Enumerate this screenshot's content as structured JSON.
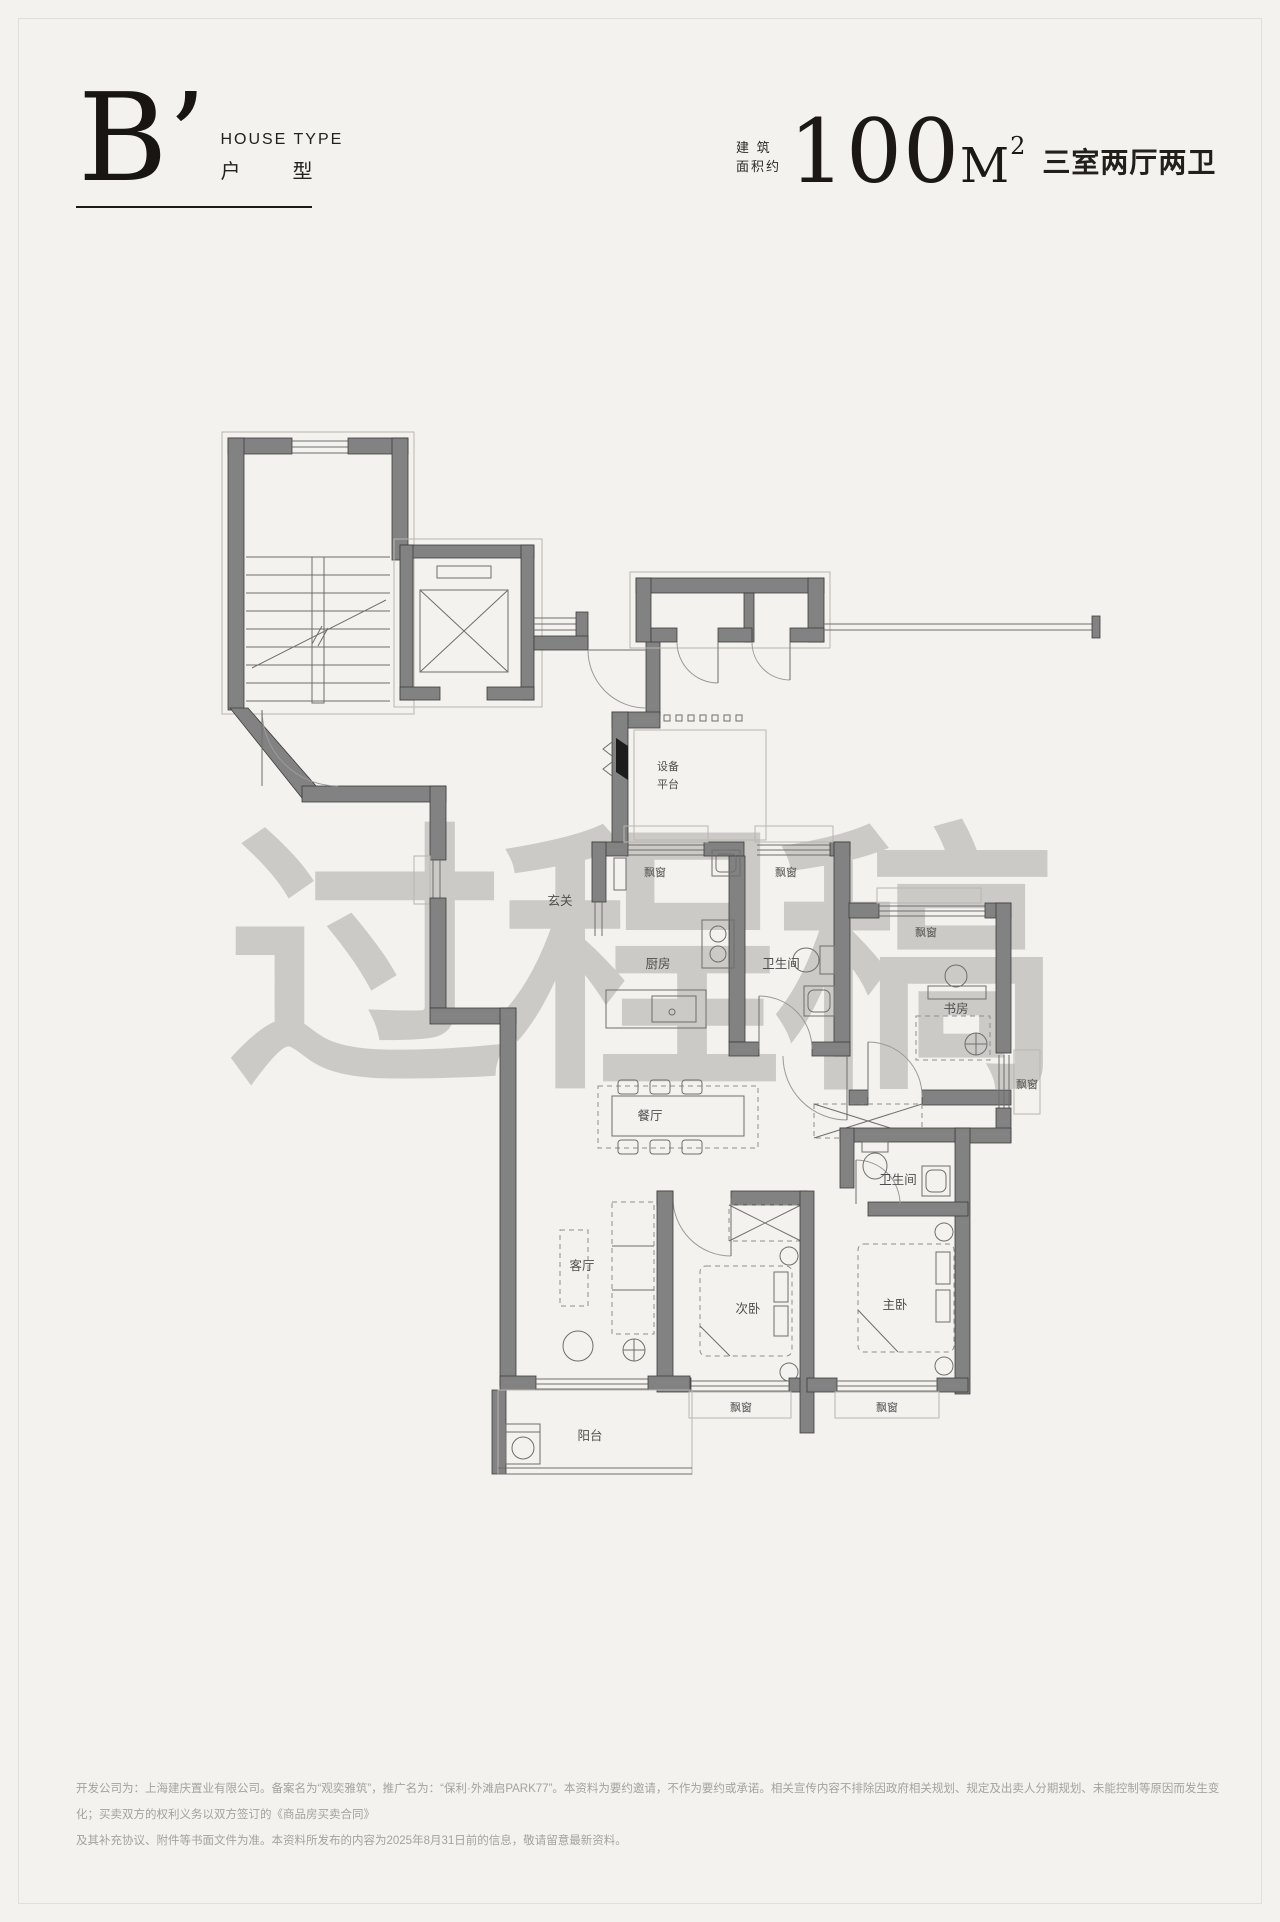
{
  "page": {
    "background": "#f4f2ef",
    "frame_border": "#e2dfd9",
    "accent": "#1b1815",
    "wall_color": "#828282"
  },
  "header": {
    "type_letter": "B’",
    "type_label_en": "HOUSE TYPE",
    "type_label_cn_1": "户",
    "type_label_cn_2": "型",
    "area_prefix_line1": "建 筑",
    "area_prefix_line2": "面积约",
    "area_value": "100",
    "area_unit": "M",
    "area_sup": "2",
    "rooms_summary": "三室两厅两卫"
  },
  "plan": {
    "labels": {
      "entry": "玄关",
      "kitchen": "厨房",
      "bathroom": "卫生间",
      "dining": "餐厅",
      "living": "客厅",
      "bedroom2": "次卧",
      "master": "主卧",
      "study": "书房",
      "balcony": "阳台",
      "bay_window": "飘窗",
      "equipment_line1": "设备",
      "equipment_line2": "平台"
    }
  },
  "watermark": {
    "text": "过程稿",
    "color": "#b5b2ad"
  },
  "footer": {
    "line1": "开发公司为：上海建庆置业有限公司。备案名为“观奕雅筑”，推广名为：“保利·外滩启PARK77”。本资料为要约邀请，不作为要约或承诺。相关宣传内容不排除因政府相关规划、规定及出卖人分期规划、未能控制等原因而发生变化；买卖双方的权利义务以双方签订的《商品房买卖合同》",
    "line2": "及其补充协议、附件等书面文件为准。本资料所发布的内容为2025年8月31日前的信息，敬请留意最新资料。"
  }
}
